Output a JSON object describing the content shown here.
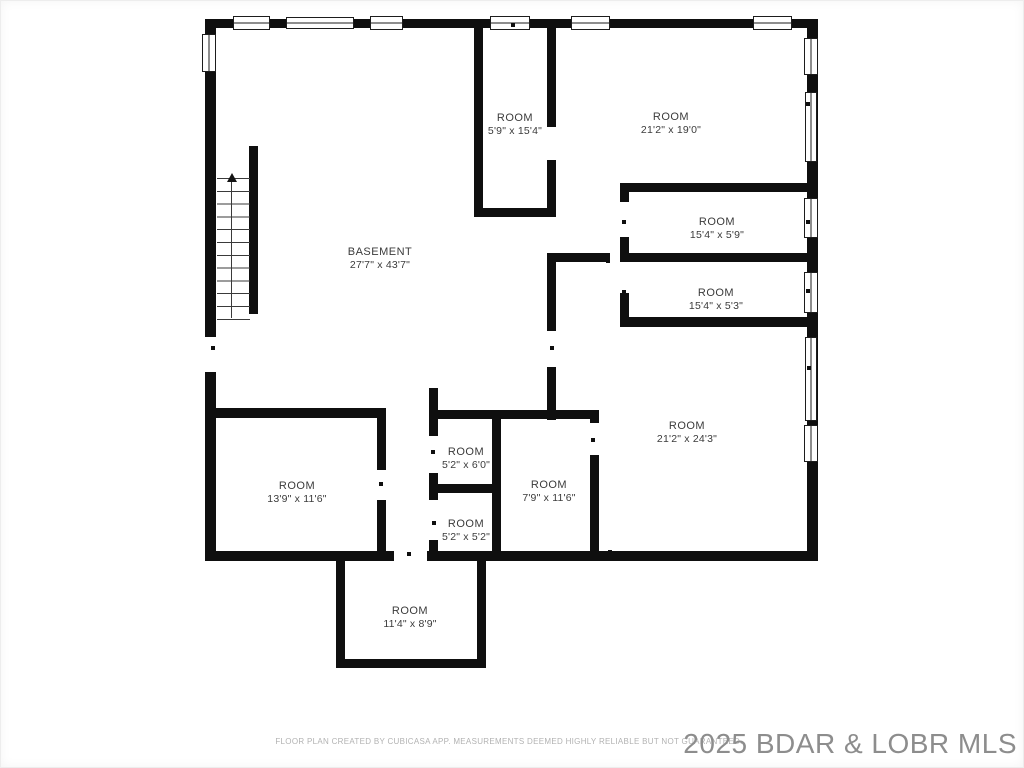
{
  "plan": {
    "rooms": [
      {
        "name": "BASEMENT",
        "dims": "27'7\" x 43'7\""
      },
      {
        "name": "ROOM",
        "dims": "5'9\" x 15'4\""
      },
      {
        "name": "ROOM",
        "dims": "21'2\" x 19'0\""
      },
      {
        "name": "ROOM",
        "dims": "15'4\" x 5'9\""
      },
      {
        "name": "ROOM",
        "dims": "15'4\" x 5'3\""
      },
      {
        "name": "ROOM",
        "dims": "21'2\" x 24'3\""
      },
      {
        "name": "ROOM",
        "dims": "13'9\" x 11'6\""
      },
      {
        "name": "ROOM",
        "dims": "5'2\" x 6'0\""
      },
      {
        "name": "ROOM",
        "dims": "5'2\" x 5'2\""
      },
      {
        "name": "ROOM",
        "dims": "7'9\" x 11'6\""
      },
      {
        "name": "ROOM",
        "dims": "11'4\" x 8'9\""
      }
    ],
    "walls": [
      [
        205,
        19,
        613,
        9
      ],
      [
        205,
        19,
        11,
        542
      ],
      [
        205,
        551,
        613,
        10
      ],
      [
        807,
        19,
        11,
        542
      ],
      [
        249,
        146,
        9,
        168
      ],
      [
        474,
        23,
        9,
        194
      ],
      [
        547,
        23,
        9,
        194
      ],
      [
        474,
        208,
        82,
        9
      ],
      [
        547,
        253,
        9,
        167
      ],
      [
        547,
        253,
        63,
        9
      ],
      [
        620,
        253,
        189,
        9
      ],
      [
        620,
        183,
        189,
        9
      ],
      [
        620,
        183,
        9,
        144
      ],
      [
        620,
        317,
        189,
        10
      ],
      [
        205,
        408,
        180,
        10
      ],
      [
        377,
        408,
        9,
        153
      ],
      [
        429,
        388,
        9,
        173
      ],
      [
        429,
        484,
        71,
        9
      ],
      [
        492,
        410,
        9,
        151
      ],
      [
        429,
        410,
        169,
        9
      ],
      [
        590,
        410,
        9,
        151
      ],
      [
        336,
        555,
        9,
        113
      ],
      [
        477,
        555,
        9,
        113
      ],
      [
        336,
        659,
        150,
        9
      ]
    ],
    "openings": [
      [
        204,
        337,
        13,
        35
      ],
      [
        394,
        550,
        33,
        12
      ],
      [
        546,
        127,
        11,
        33
      ],
      [
        546,
        331,
        11,
        36
      ],
      [
        619,
        202,
        11,
        35
      ],
      [
        619,
        262,
        11,
        31
      ],
      [
        376,
        470,
        11,
        30
      ],
      [
        428,
        436,
        11,
        37
      ],
      [
        428,
        500,
        11,
        40
      ],
      [
        589,
        423,
        11,
        32
      ]
    ],
    "windows_h": [
      [
        233,
        16,
        37,
        14
      ],
      [
        286,
        17,
        68,
        12
      ],
      [
        370,
        16,
        33,
        14
      ],
      [
        490,
        16,
        40,
        14
      ],
      [
        571,
        16,
        39,
        14
      ],
      [
        753,
        16,
        39,
        14
      ]
    ],
    "windows_v": [
      [
        202,
        34,
        14,
        38
      ],
      [
        804,
        38,
        14,
        37
      ],
      [
        805,
        92,
        12,
        70
      ],
      [
        804,
        198,
        14,
        40
      ],
      [
        804,
        272,
        14,
        41
      ],
      [
        805,
        337,
        12,
        84
      ],
      [
        804,
        425,
        14,
        37
      ]
    ],
    "markers": [
      [
        513,
        25
      ],
      [
        467,
        413
      ],
      [
        297,
        412
      ],
      [
        297,
        553
      ],
      [
        409,
        554
      ],
      [
        343,
        611
      ],
      [
        409,
        661
      ],
      [
        479,
        612
      ],
      [
        466,
        554
      ],
      [
        478,
        104
      ],
      [
        553,
        105
      ],
      [
        552,
        348
      ],
      [
        213,
        348
      ],
      [
        624,
        187
      ],
      [
        624,
        222
      ],
      [
        624,
        292
      ],
      [
        717,
        186
      ],
      [
        717,
        256
      ],
      [
        717,
        321
      ],
      [
        808,
        104
      ],
      [
        808,
        222
      ],
      [
        808,
        291
      ],
      [
        809,
        368
      ],
      [
        595,
        483
      ],
      [
        610,
        552
      ],
      [
        433,
        452
      ],
      [
        434,
        523
      ],
      [
        381,
        484
      ],
      [
        593,
        440
      ],
      [
        586,
        255
      ],
      [
        608,
        261
      ],
      [
        513,
        211
      ],
      [
        687,
        320
      ],
      [
        687,
        186
      ]
    ]
  },
  "footer": {
    "disclaimer": "FLOOR PLAN CREATED BY CUBICASA APP. MEASUREMENTS DEEMED HIGHLY RELIABLE BUT NOT GUARANTEED."
  },
  "watermark": {
    "text": "2025 BDAR & LOBR MLS"
  },
  "colors": {
    "wall": "#0f0f0f",
    "label": "#3b3b3b",
    "footer_text": "#b2b2b2",
    "watermark_text": "#8d8d8d",
    "background": "#ffffff"
  }
}
